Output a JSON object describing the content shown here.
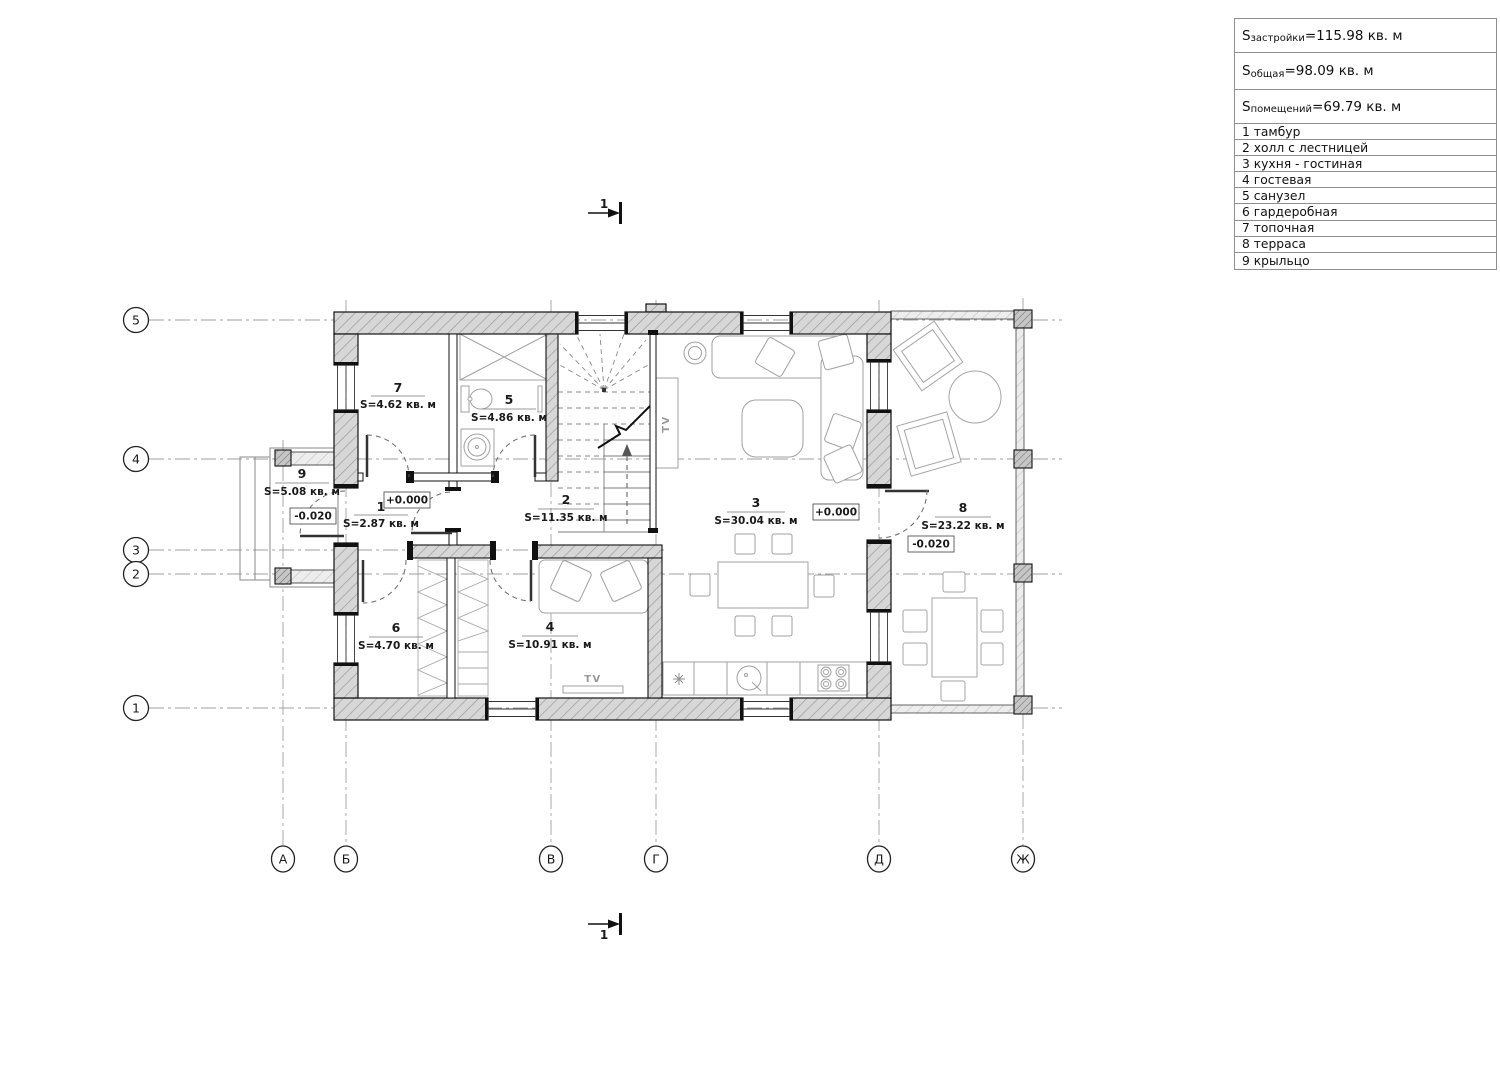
{
  "legend": {
    "stats": [
      {
        "s": "S",
        "sub": "застройки",
        "rest": "=115.98 кв. м"
      },
      {
        "s": "S",
        "sub": "общая",
        "rest": "=98.09 кв. м"
      },
      {
        "s": "S",
        "sub": "помещений",
        "rest": "=69.79 кв. м"
      }
    ],
    "rooms": [
      "1 тамбур",
      "2 холл с лестницей",
      "3 кухня - гостиная",
      "4 гостевая",
      "5 санузел",
      "6 гардеробная",
      "7 топочная",
      "8 терраса",
      "9 крыльцо"
    ]
  },
  "axes": {
    "rows": [
      "5",
      "4",
      "3",
      "2",
      "1"
    ],
    "cols": [
      "А",
      "Б",
      "В",
      "Г",
      "Д",
      "Ж"
    ]
  },
  "section": {
    "top": "1",
    "bottom": "1"
  },
  "plan_rooms": {
    "r7": {
      "num": "7",
      "area": "S=4.62 кв. м"
    },
    "r5": {
      "num": "5",
      "area": "S=4.86 кв. м"
    },
    "r9": {
      "num": "9",
      "area": "S=5.08 кв. м"
    },
    "r1": {
      "num": "1",
      "area": "S=2.87 кв. м"
    },
    "r2": {
      "num": "2",
      "area": "S=11.35 кв. м"
    },
    "r3": {
      "num": "3",
      "area": "S=30.04 кв. м"
    },
    "r8": {
      "num": "8",
      "area": "S=23.22 кв. м"
    },
    "r6": {
      "num": "6",
      "area": "S=4.70 кв. м"
    },
    "r4": {
      "num": "4",
      "area": "S=10.91 кв. м"
    }
  },
  "elevations": {
    "vestibule": "+0.000",
    "porch": "-0.020",
    "living": "+0.000",
    "terrace": "-0.020"
  },
  "labels": {
    "tv_living": "TV",
    "tv_guest": "TV"
  }
}
